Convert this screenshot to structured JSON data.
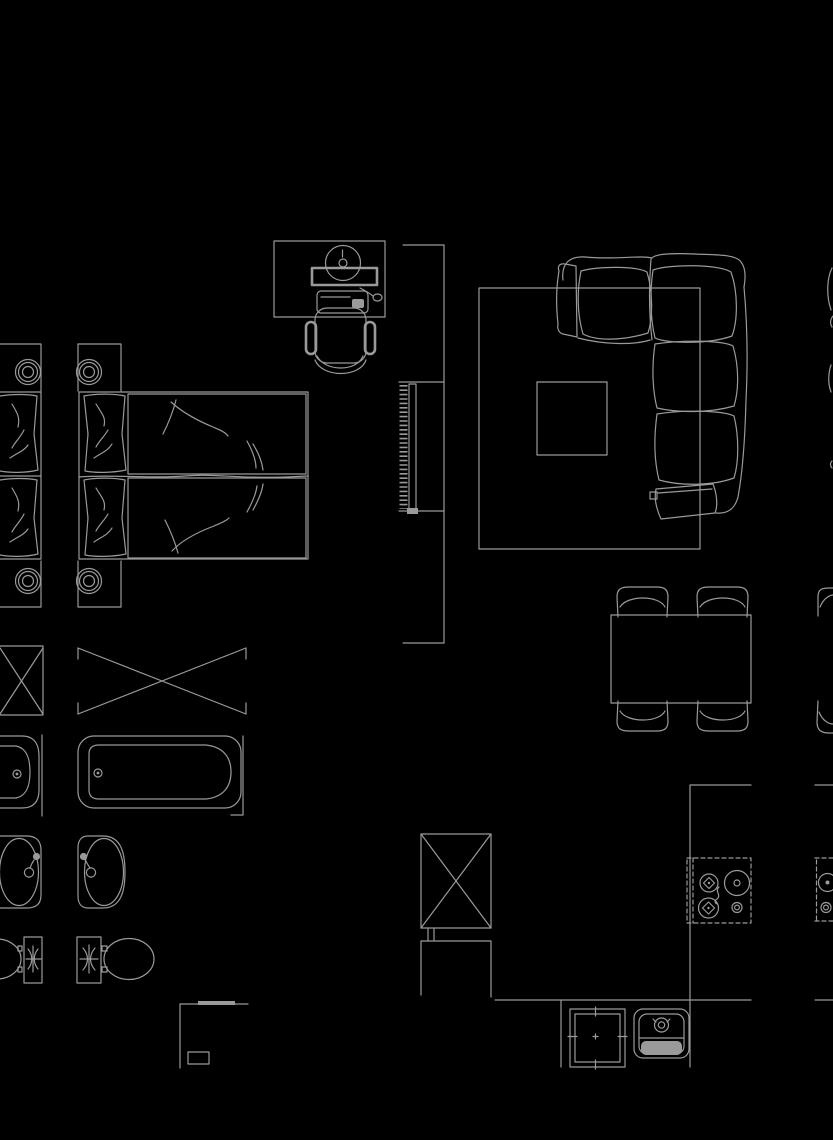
{
  "app": {
    "label": "CAD furniture block library sheet",
    "background": "model-space"
  },
  "colors": {
    "line": "#9a9a9a",
    "bg": "#000000"
  },
  "canvas": {
    "width": 833,
    "height": 1140
  },
  "blocks": [
    {
      "label": "double bed with pillows, duvets and bedside lamps",
      "kind": "bed"
    },
    {
      "label": "partial narrow bed at left edge",
      "kind": "bed"
    },
    {
      "label": "computer desk with monitor, keyboard, mouse and office chair",
      "kind": "desk"
    },
    {
      "label": "wall cabinet with radiator fins",
      "kind": "radiator"
    },
    {
      "label": "L-shaped sectional sofa with rug and coffee table",
      "kind": "sofa"
    },
    {
      "label": "dining table with four chairs",
      "kind": "dining"
    },
    {
      "label": "partial dining chairs at right edge",
      "kind": "dining"
    },
    {
      "label": "shower tray crossed box",
      "kind": "shower"
    },
    {
      "label": "partial narrow shower box at left edge",
      "kind": "shower"
    },
    {
      "label": "bathtub with drain",
      "kind": "bathtub"
    },
    {
      "label": "partial narrow bathtub at left edge",
      "kind": "bathtub"
    },
    {
      "label": "washbasin with tap",
      "kind": "sink"
    },
    {
      "label": "partial washbasin at left edge",
      "kind": "sink"
    },
    {
      "label": "toilet with cistern",
      "kind": "toilet"
    },
    {
      "label": "partial toilet at left edge",
      "kind": "toilet"
    },
    {
      "label": "tall cabinet with crossed front",
      "kind": "cabinet"
    },
    {
      "label": "room corner outline with socket box",
      "kind": "wall"
    },
    {
      "label": "kitchen counter outline",
      "kind": "counter"
    },
    {
      "label": "built-in oven",
      "kind": "oven"
    },
    {
      "label": "kitchen sink with faucet",
      "kind": "sink"
    },
    {
      "label": "four burner cooktop",
      "kind": "cooktop"
    },
    {
      "label": "partial cooktop at right edge",
      "kind": "cooktop"
    },
    {
      "label": "partial sofa slivers at right edge",
      "kind": "sofa"
    }
  ]
}
